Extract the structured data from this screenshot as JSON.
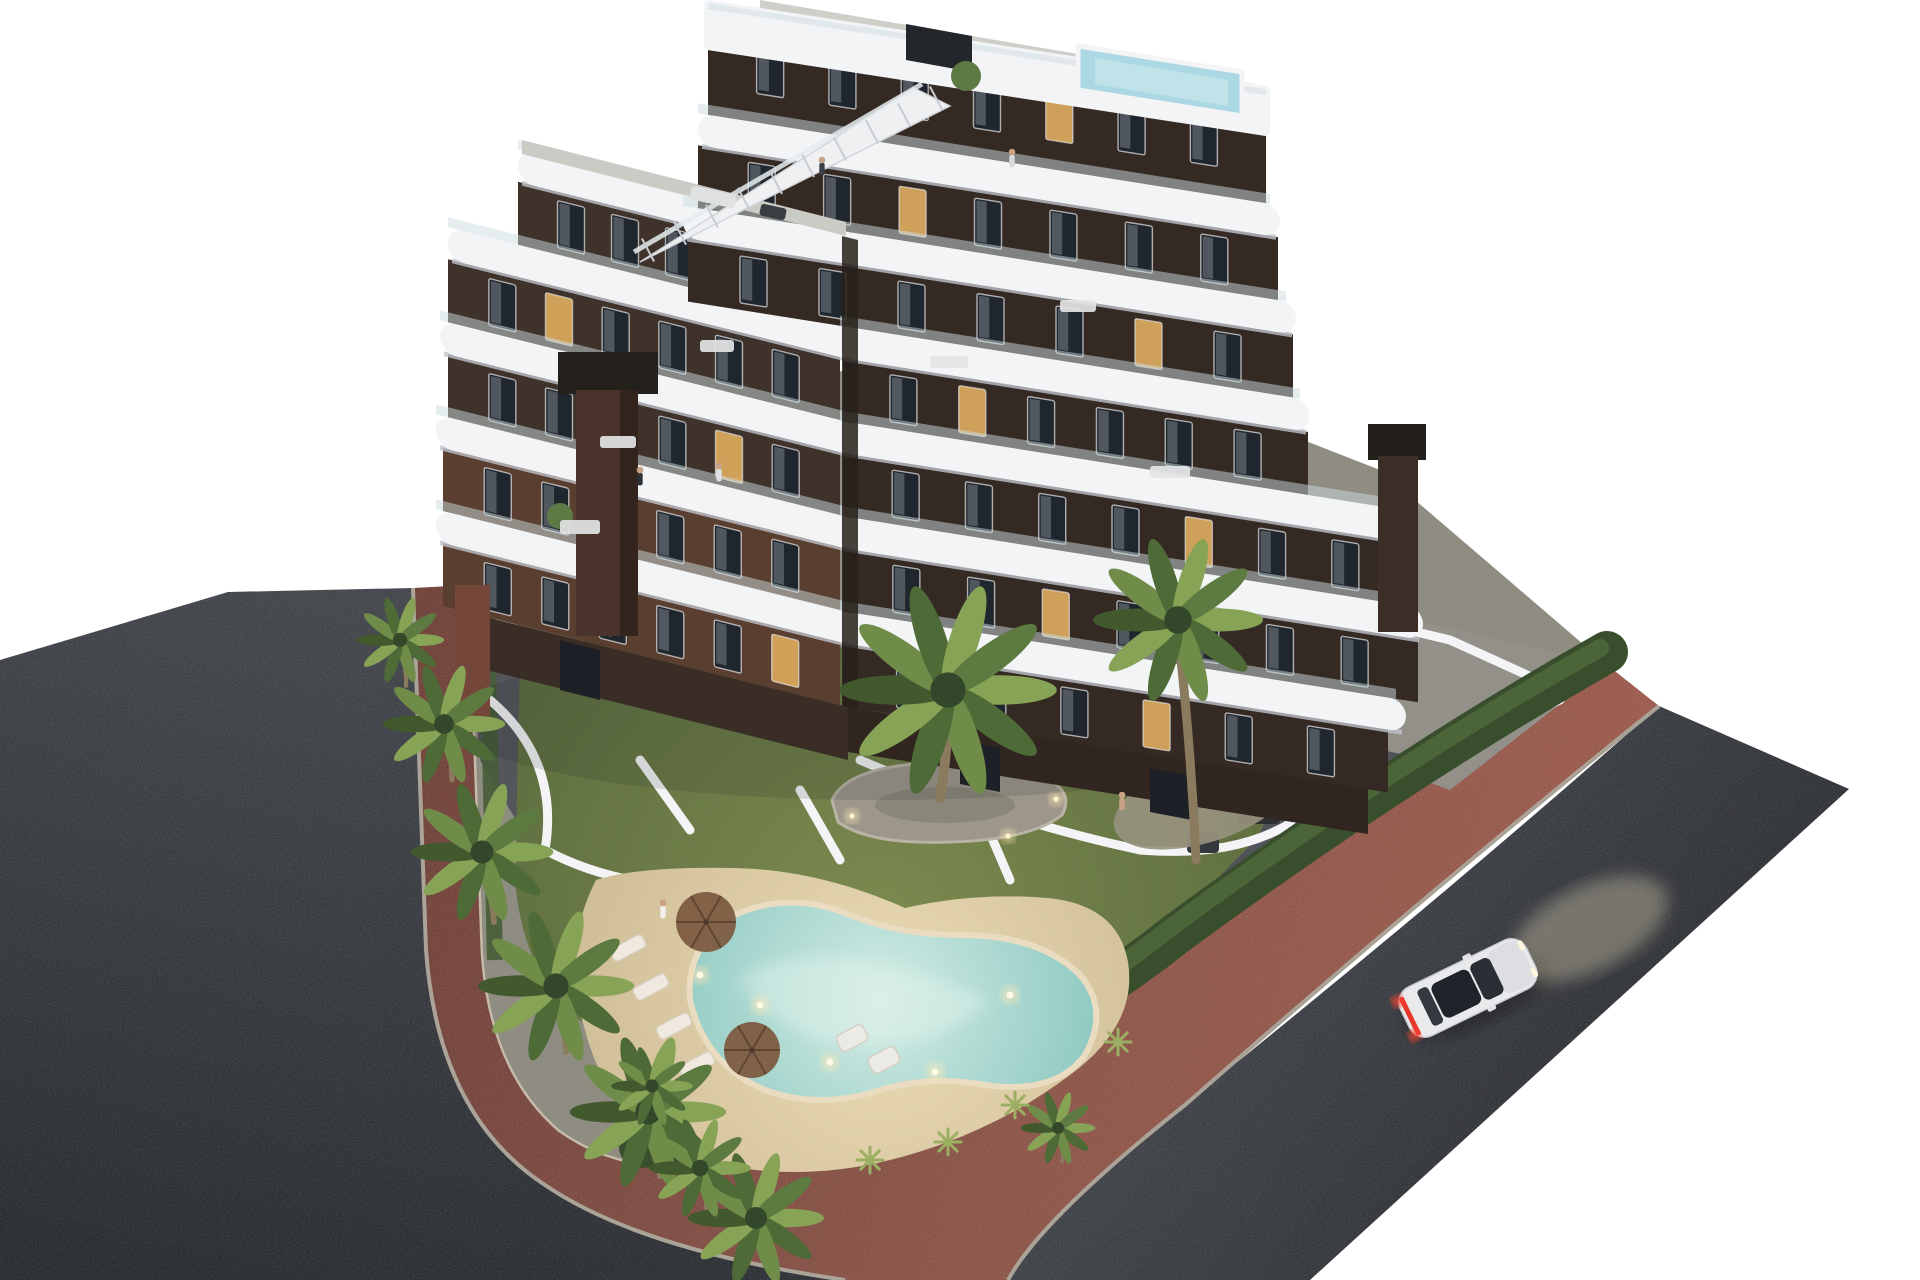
{
  "scene": {
    "type": "architectural-3d-render",
    "description": "Aerial dusk render of a modern 7-storey apartment block with curved white balcony bands, rooftop plunge pool, stair to roof deck, two dark chimneys, landscaped garden with free-form swimming pool, sun loungers, parasols, palm trees, red pedestrian paths, dark asphalt roads and a white car driving by.",
    "background": "#ffffff"
  },
  "palette": {
    "background": "#ffffff",
    "asphalt_left_top": "#41444a",
    "asphalt_left_bottom": "#26292e",
    "asphalt_right_top": "#3d4046",
    "asphalt_right_bottom": "#25272b",
    "red_path_dark": "#6f4038",
    "red_path_light": "#9a5a4b",
    "curb": "#c3b8a6",
    "concrete": "#8f8c82",
    "courtyard": "#a39e90",
    "terrace_tile": "#50545a",
    "lawn_light": "#7c8a4f",
    "lawn_dark": "#57683c",
    "hedge_dark": "#394e2d",
    "hedge_light": "#4b6539",
    "sand_light": "#ecdcb5",
    "sand_dark": "#cdbc95",
    "water_edge": "#8cc8c1",
    "water_center": "#d2ece4",
    "palm_green_light": "#87a356",
    "palm_green_dark": "#4e6a36",
    "trunk": "#8a7a5e",
    "facade_dark": "#3e322a",
    "facade_darker": "#352a23",
    "facade_brick": "#5a3e2f",
    "slab_white": "#f3f4f6",
    "railing_glass": "#ccdbe0",
    "window_dark": "#20262d",
    "window_lit": "#d8a75c",
    "window_frame": "#e8e8ea",
    "roof_deck": "#cfcfca",
    "roof_pool": "#abd8e2",
    "chimney_dark": "#24211d",
    "chimney_brick": "#4a332a",
    "car_body": "#e9eaec",
    "car_glass": "#2b2e34",
    "taillight": "#e6372b",
    "headlight_glow": "#f5e9c4",
    "pebble": "#9d978b",
    "light_warm": "#ffe9b4",
    "wall_white": "#f4f4f6",
    "person_skin": "#c9a184",
    "shadow": "#1e2420"
  },
  "building": {
    "corner_x": 848,
    "skew_left_deg": 14,
    "skew_right_deg": 9,
    "band_height": 63,
    "slab_height": 32,
    "window_height": 47,
    "left_bands": [
      {
        "top": 264,
        "x0": -330,
        "x1": -8,
        "windows": 5
      },
      {
        "top": 359,
        "x0": -400,
        "x1": -8,
        "windows": 6
      },
      {
        "top": 454,
        "x0": -400,
        "x1": -8,
        "windows": 6
      },
      {
        "top": 549,
        "x0": -405,
        "x1": -8,
        "windows": 6,
        "brick": true
      },
      {
        "top": 644,
        "x0": -405,
        "x1": -8,
        "windows": 6,
        "brick": true
      }
    ],
    "right_bands": [
      {
        "top": 52,
        "h": 85,
        "x0": -140,
        "x1": 418,
        "windows": 7
      },
      {
        "top": 169,
        "x0": -150,
        "x1": 430,
        "windows": 7
      },
      {
        "top": 264,
        "x0": -160,
        "x1": 445,
        "windows": 7
      },
      {
        "top": 359,
        "x0": -5,
        "x1": 460,
        "windows": 6
      },
      {
        "top": 454,
        "x0": -5,
        "x1": 560,
        "windows": 7
      },
      {
        "top": 549,
        "x0": -5,
        "x1": 570,
        "windows": 7
      },
      {
        "top": 644,
        "x0": -5,
        "x1": 540,
        "windows": 6
      }
    ],
    "left_slabs": [
      {
        "y": 232,
        "x0": -330,
        "x1": 12
      },
      {
        "y": 327,
        "x0": -400,
        "x1": 12
      },
      {
        "y": 422,
        "x0": -408,
        "x1": 12
      },
      {
        "y": 517,
        "x0": -412,
        "x1": 12
      },
      {
        "y": 612,
        "x0": -412,
        "x1": 12
      }
    ],
    "right_slabs": [
      {
        "y": 137,
        "x0": -150,
        "x1": 432
      },
      {
        "y": 232,
        "x0": -165,
        "x1": 448
      },
      {
        "y": 327,
        "x0": -8,
        "x1": 462
      },
      {
        "y": 422,
        "x0": -8,
        "x1": 565
      },
      {
        "y": 517,
        "x0": -8,
        "x1": 575
      },
      {
        "y": 612,
        "x0": -8,
        "x1": 558
      }
    ],
    "lit_windows_left": [
      [
        1,
        1
      ],
      [
        2,
        4
      ],
      [
        3,
        2
      ],
      [
        4,
        5
      ]
    ],
    "lit_windows_right": [
      [
        0,
        4
      ],
      [
        1,
        2
      ],
      [
        2,
        5
      ],
      [
        3,
        1
      ],
      [
        4,
        4
      ],
      [
        5,
        2
      ],
      [
        6,
        3
      ]
    ],
    "stairs": {
      "x1": 648,
      "y1": 250,
      "x2": 936,
      "y2": 98,
      "steps": 9
    }
  },
  "garden": {
    "palms": [
      [
        400,
        640,
        1.3
      ],
      [
        444,
        724,
        1.8
      ],
      [
        482,
        852,
        2.1
      ],
      [
        556,
        986,
        2.3
      ],
      [
        648,
        1112,
        2.3
      ],
      [
        756,
        1218,
        2.0
      ],
      [
        700,
        1168,
        1.5
      ],
      [
        948,
        690,
        3.2
      ],
      [
        1178,
        620,
        2.5
      ],
      [
        652,
        1086,
        1.2
      ],
      [
        1058,
        1128,
        1.1
      ]
    ],
    "palm_trunks": [
      [
        948,
        702,
        940,
        798,
        10
      ],
      [
        1178,
        632,
        1196,
        860,
        9
      ],
      [
        482,
        862,
        494,
        922,
        6
      ],
      [
        556,
        996,
        566,
        1052,
        6
      ],
      [
        648,
        1122,
        660,
        1176,
        6
      ],
      [
        444,
        734,
        452,
        780,
        5
      ],
      [
        756,
        1226,
        764,
        1262,
        5
      ],
      [
        652,
        1092,
        658,
        1128,
        4
      ],
      [
        400,
        648,
        406,
        686,
        4
      ],
      [
        1058,
        1134,
        1062,
        1162,
        3
      ],
      [
        700,
        1174,
        706,
        1208,
        4
      ]
    ],
    "pool_lights": [
      [
        760,
        1005
      ],
      [
        830,
        1062
      ],
      [
        935,
        1072
      ],
      [
        1010,
        995
      ],
      [
        700,
        975
      ]
    ],
    "island_lights": [
      [
        852,
        816
      ],
      [
        1008,
        836
      ],
      [
        1056,
        799
      ]
    ],
    "loungers": [
      [
        628,
        948
      ],
      [
        651,
        987
      ],
      [
        674,
        1026
      ],
      [
        697,
        1065
      ]
    ],
    "umbrellas": [
      [
        706,
        922,
        30
      ],
      [
        752,
        1050,
        28
      ]
    ],
    "sofas": [
      [
        852,
        1038
      ],
      [
        884,
        1060
      ]
    ],
    "tables": [
      [
        872,
        698,
        64,
        20
      ],
      [
        1062,
        742,
        70,
        22
      ]
    ],
    "dark_sets": [
      [
        1238,
        798,
        42,
        26
      ],
      [
        1187,
        833,
        32,
        20
      ]
    ],
    "yuccas": [
      [
        1015,
        1105
      ],
      [
        948,
        1142
      ],
      [
        1118,
        1042
      ],
      [
        870,
        1160
      ]
    ]
  },
  "people": [
    [
      663,
      903,
      "#f2f0ec"
    ],
    [
      1122,
      795,
      "#c9a184"
    ],
    [
      640,
      470,
      "#2e3338"
    ],
    [
      719,
      466,
      "#dfe2e5"
    ],
    [
      822,
      160,
      "#3a3f45"
    ],
    [
      1012,
      152,
      "#d8dadc"
    ]
  ],
  "car": {
    "x": 1468,
    "y": 988,
    "angle": -26,
    "color": "white",
    "taillights": "on"
  }
}
